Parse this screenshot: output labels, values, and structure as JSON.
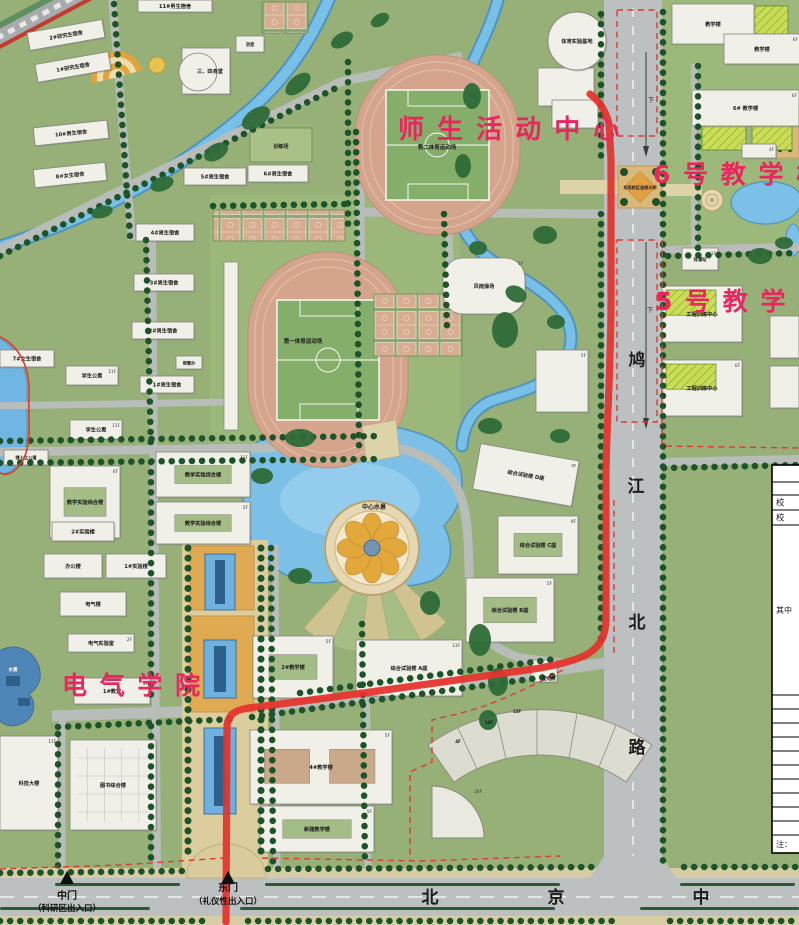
{
  "accent_pink": "#e8275e",
  "route": {
    "color": "#e5312b",
    "width": 7.2
  },
  "highlight_labels": [
    {
      "text": "师 生 活 动 中 心",
      "x": 398,
      "y": 138,
      "size": 26
    },
    {
      "text": "6 号 教 学 楼",
      "x": 653,
      "y": 183,
      "size": 25
    },
    {
      "text": "5 号 教 学 楼",
      "x": 655,
      "y": 310,
      "size": 25
    },
    {
      "text": "电 气 学 院",
      "x": 62,
      "y": 694,
      "size": 25
    }
  ],
  "road_labels": {
    "vertical_road_chars": [
      {
        "ch": "鸠",
        "x": 637,
        "y": 366
      },
      {
        "ch": "江",
        "x": 636,
        "y": 492
      },
      {
        "ch": "北",
        "x": 637,
        "y": 628
      },
      {
        "ch": "路",
        "x": 637,
        "y": 753
      }
    ],
    "bottom_road_chars": [
      {
        "ch": "北",
        "x": 430,
        "y": 903
      },
      {
        "ch": "京",
        "x": 556,
        "y": 903
      },
      {
        "ch": "中",
        "x": 701,
        "y": 903
      }
    ],
    "lane_hints": [
      {
        "ch": "下",
        "x": 651,
        "y": 102
      },
      {
        "ch": "下",
        "x": 650,
        "y": 312
      }
    ]
  },
  "gates": [
    {
      "name": "中门",
      "sub": "（科研区出入口）",
      "x": 67,
      "name_y": 899,
      "sub_y": 911
    },
    {
      "name": "东门",
      "sub": "（礼仪性出入口）",
      "x": 228,
      "name_y": 891,
      "sub_y": 904
    }
  ],
  "area_labels": [
    {
      "t": "第二体育运动场",
      "x": 437,
      "y": 149,
      "s": 5.5
    },
    {
      "t": "第一体育运动场",
      "x": 303,
      "y": 343,
      "s": 5.5
    },
    {
      "t": "中心水景",
      "x": 374,
      "y": 509,
      "s": 6
    },
    {
      "t": "东西校区连接天桥",
      "x": 640,
      "y": 189,
      "s": 4.2
    },
    {
      "t": "训练场",
      "x": 281,
      "y": 148,
      "s": 5
    },
    {
      "t": "水景",
      "x": 13,
      "y": 671,
      "s": 4.5,
      "c": "#ffffff"
    },
    {
      "t": "配电房",
      "x": 549,
      "y": 680,
      "s": 4.5
    },
    {
      "t": "4F",
      "x": 458,
      "y": 743,
      "s": 4
    },
    {
      "t": "13F",
      "x": 489,
      "y": 724,
      "s": 4
    },
    {
      "t": "15F",
      "x": 517,
      "y": 713,
      "s": 4
    }
  ],
  "buildings": [
    {
      "x": 28,
      "y": 26,
      "w": 76,
      "h": 18,
      "r": -10,
      "l": "2#研究生宿舍"
    },
    {
      "x": 36,
      "y": 58,
      "w": 74,
      "h": 18,
      "r": -10,
      "l": "1#研究生宿舍"
    },
    {
      "x": 34,
      "y": 124,
      "w": 74,
      "h": 18,
      "r": -6,
      "l": "10#男生宿舍"
    },
    {
      "x": 34,
      "y": 166,
      "w": 72,
      "h": 18,
      "r": -6,
      "l": "8#女生宿舍"
    },
    {
      "x": 138,
      "y": 0,
      "w": 74,
      "h": 12,
      "l": "11#男生宿舍"
    },
    {
      "x": 184,
      "y": 168,
      "w": 62,
      "h": 17,
      "l": "5#男生宿舍"
    },
    {
      "x": 248,
      "y": 165,
      "w": 60,
      "h": 17,
      "l": "6#男生宿舍"
    },
    {
      "x": 182,
      "y": 48,
      "w": 48,
      "h": 46,
      "l": "三、四食堂",
      "sh": "canteen"
    },
    {
      "x": 236,
      "y": 36,
      "w": 28,
      "h": 16,
      "l": "浴室",
      "s": 4.3
    },
    {
      "x": 136,
      "y": 224,
      "w": 58,
      "h": 17,
      "l": "4#男生宿舍"
    },
    {
      "x": 134,
      "y": 274,
      "w": 60,
      "h": 17,
      "l": "3#男生宿舍"
    },
    {
      "x": 132,
      "y": 322,
      "w": 62,
      "h": 17,
      "l": "2#男生宿舍"
    },
    {
      "x": 0,
      "y": 350,
      "w": 54,
      "h": 17,
      "l": "7#女生宿舍"
    },
    {
      "x": 140,
      "y": 376,
      "w": 54,
      "h": 17,
      "l": "1#男生宿舍"
    },
    {
      "x": 176,
      "y": 356,
      "w": 26,
      "h": 13,
      "l": "宿管办",
      "s": 4.2
    },
    {
      "x": 66,
      "y": 366,
      "w": 52,
      "h": 19,
      "l": "学生公寓",
      "f": "11F"
    },
    {
      "x": 70,
      "y": 420,
      "w": 52,
      "h": 19,
      "l": "学生公寓",
      "f": "11F"
    },
    {
      "x": 4,
      "y": 450,
      "w": 44,
      "h": 15,
      "l": "博士生公寓",
      "s": 4.3
    },
    {
      "x": 50,
      "y": 466,
      "w": 70,
      "h": 72,
      "l": "教学实验综合楼",
      "f": "6F",
      "sh": "court"
    },
    {
      "x": 156,
      "y": 452,
      "w": 94,
      "h": 45,
      "l": "教学实验综合楼",
      "f": "11F",
      "sh": "court"
    },
    {
      "x": 156,
      "y": 502,
      "w": 94,
      "h": 42,
      "l": "教学实验综合楼",
      "f": "5F",
      "sh": "court"
    },
    {
      "x": 52,
      "y": 522,
      "w": 62,
      "h": 19,
      "l": "2#实验楼"
    },
    {
      "x": 44,
      "y": 554,
      "w": 58,
      "h": 24,
      "l": "办公楼"
    },
    {
      "x": 106,
      "y": 554,
      "w": 60,
      "h": 24,
      "l": "1#实验楼"
    },
    {
      "x": 60,
      "y": 592,
      "w": 66,
      "h": 24,
      "l": "电气楼"
    },
    {
      "x": 68,
      "y": 634,
      "w": 66,
      "h": 18,
      "l": "电气实验室",
      "f": "2F"
    },
    {
      "x": 74,
      "y": 678,
      "w": 76,
      "h": 26,
      "l": "1#教室",
      "f": "5F"
    },
    {
      "x": 0,
      "y": 736,
      "w": 58,
      "h": 94,
      "l": "科技大楼",
      "f": "11F"
    },
    {
      "x": 70,
      "y": 740,
      "w": 86,
      "h": 90,
      "l": "图书综合楼",
      "f": "6F",
      "sh": "grid"
    },
    {
      "x": 253,
      "y": 636,
      "w": 80,
      "h": 62,
      "l": "2#教学楼",
      "f": "5F",
      "sh": "court"
    },
    {
      "x": 250,
      "y": 730,
      "w": 142,
      "h": 74,
      "l": "4#教学楼",
      "f": "5F",
      "sh": "court2"
    },
    {
      "x": 260,
      "y": 806,
      "w": 114,
      "h": 46,
      "l": "新建教学楼",
      "f": "5F",
      "sh": "court"
    },
    {
      "x": 356,
      "y": 640,
      "w": 106,
      "h": 56,
      "l": "综合试验楼  A座",
      "f": "13F"
    },
    {
      "x": 531,
      "y": 660,
      "w": 26,
      "h": 22
    },
    {
      "x": 466,
      "y": 578,
      "w": 88,
      "h": 64,
      "l": "综合试验楼  B座",
      "f": "5F",
      "sh": "court"
    },
    {
      "x": 498,
      "y": 516,
      "w": 80,
      "h": 58,
      "l": "综合试验楼  C座",
      "f": "9F",
      "sh": "court"
    },
    {
      "x": 476,
      "y": 452,
      "w": 100,
      "h": 46,
      "l": "综合试验楼  D座",
      "f": "5F",
      "r": 10
    },
    {
      "x": 536,
      "y": 350,
      "w": 52,
      "h": 62,
      "f": "5F"
    },
    {
      "x": 443,
      "y": 258,
      "w": 82,
      "h": 56,
      "l": "风雨操场",
      "f": "1F",
      "sh": "round"
    },
    {
      "x": 682,
      "y": 248,
      "w": 36,
      "h": 22,
      "l": "排灌站",
      "f": "1F",
      "s": 4.3
    },
    {
      "x": 662,
      "y": 286,
      "w": 80,
      "h": 56,
      "l": "工程训练中心",
      "f": "6F",
      "sh": "lime"
    },
    {
      "x": 662,
      "y": 360,
      "w": 80,
      "h": 56,
      "l": "工程训练中心",
      "f": "6F",
      "sh": "lime"
    },
    {
      "x": 770,
      "y": 316,
      "w": 29,
      "h": 42
    },
    {
      "x": 770,
      "y": 366,
      "w": 29,
      "h": 42
    },
    {
      "x": 538,
      "y": 68,
      "w": 56,
      "h": 38
    },
    {
      "x": 552,
      "y": 100,
      "w": 46,
      "h": 28
    },
    {
      "x": 548,
      "y": 12,
      "w": 58,
      "h": 58,
      "l": "体育实验基地",
      "f": "1F",
      "sh": "circle"
    },
    {
      "x": 672,
      "y": 4,
      "w": 82,
      "h": 40,
      "l": "教学楼"
    },
    {
      "x": 724,
      "y": 34,
      "w": 76,
      "h": 30,
      "l": "教学楼",
      "f": "6F"
    },
    {
      "x": 692,
      "y": 90,
      "w": 107,
      "h": 36,
      "l": "6# 教学楼",
      "f": "6F"
    },
    {
      "x": 742,
      "y": 144,
      "w": 34,
      "h": 14,
      "f": "4F"
    },
    {
      "x": 432,
      "y": 786,
      "w": 52,
      "h": 52,
      "f": "26F",
      "sh": "fan"
    }
  ],
  "legend_table": {
    "x": 772,
    "w": 40,
    "y": 465,
    "rows": [
      {
        "h": 17,
        "t": ""
      },
      {
        "h": 13,
        "t": ""
      },
      {
        "h": 15,
        "t": "校"
      },
      {
        "h": 15,
        "t": "校"
      },
      {
        "h": 170,
        "t": "其中"
      },
      {
        "h": 14,
        "t": ""
      },
      {
        "h": 14,
        "t": ""
      },
      {
        "h": 14,
        "t": ""
      },
      {
        "h": 14,
        "t": ""
      },
      {
        "h": 14,
        "t": ""
      },
      {
        "h": 14,
        "t": ""
      },
      {
        "h": 14,
        "t": ""
      },
      {
        "h": 14,
        "t": ""
      },
      {
        "h": 14,
        "t": ""
      },
      {
        "h": 14,
        "t": ""
      },
      {
        "h": 18,
        "t": "注："
      }
    ]
  }
}
